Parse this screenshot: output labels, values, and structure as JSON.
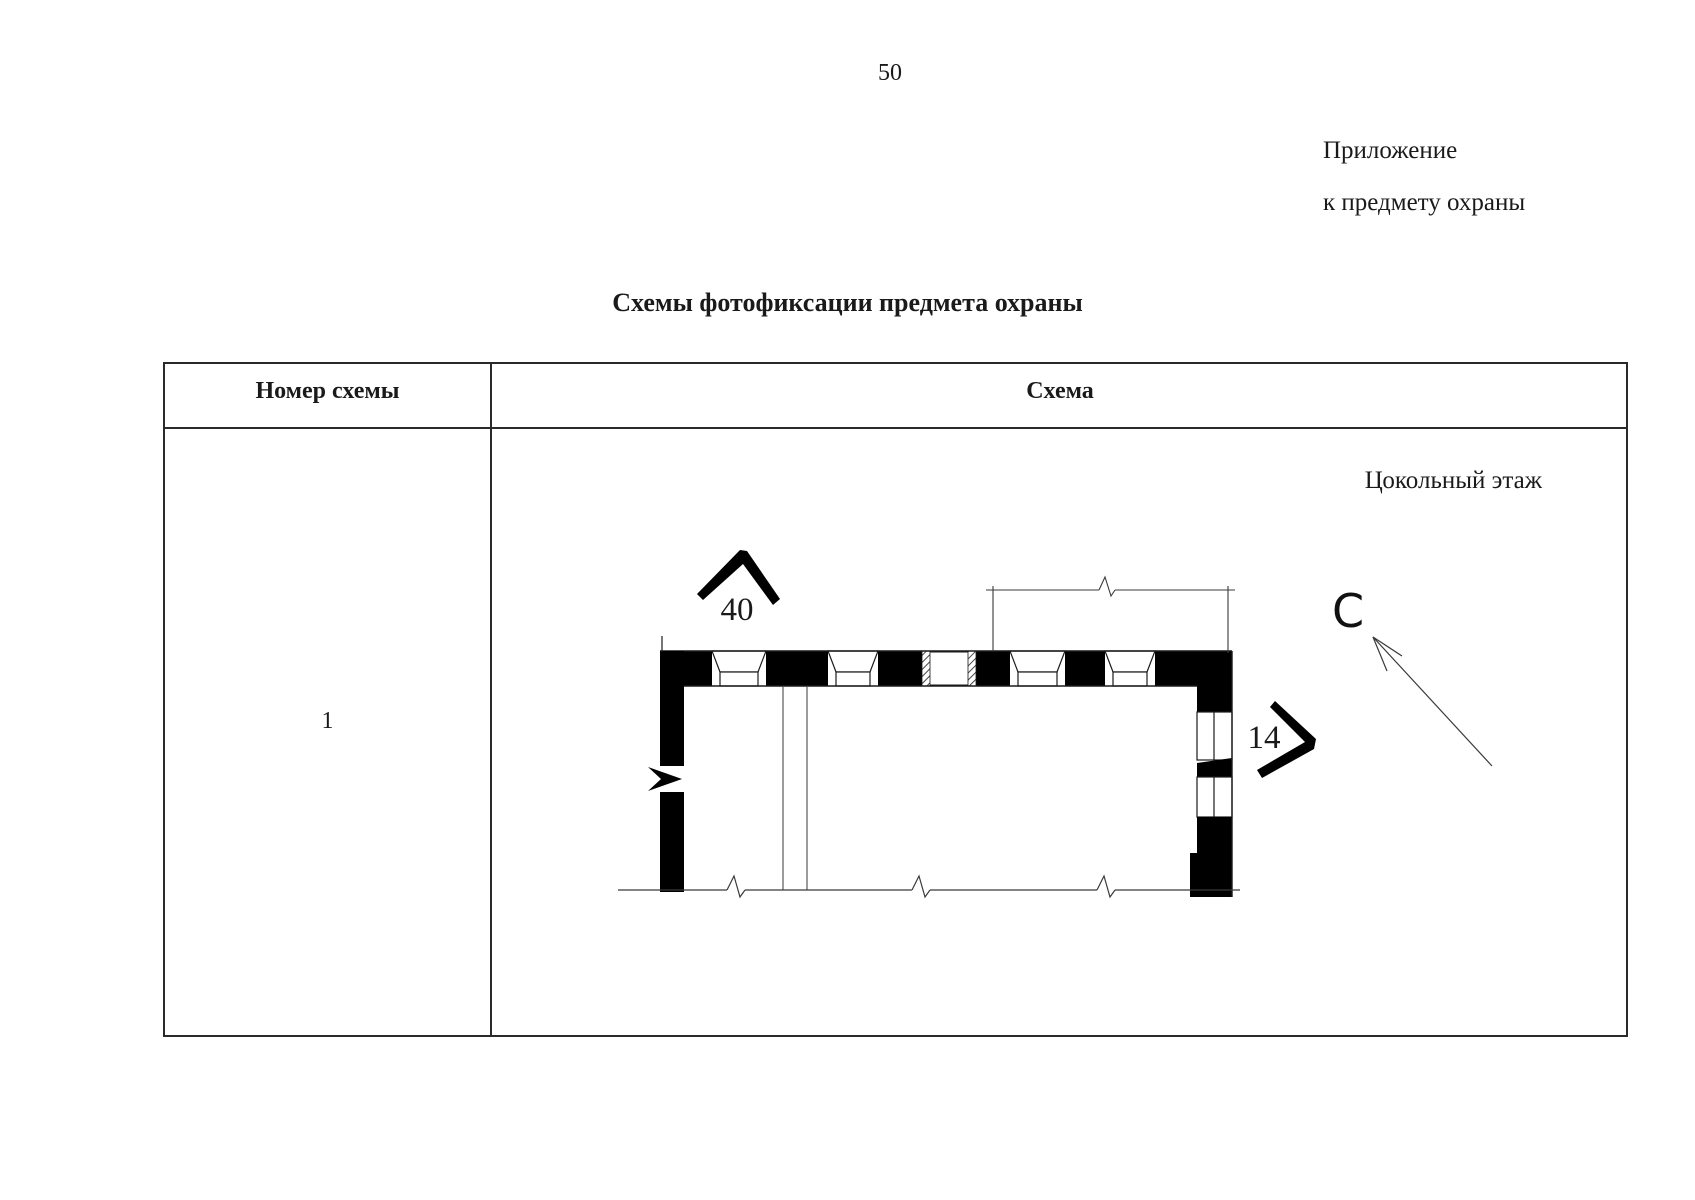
{
  "page": {
    "number": "50"
  },
  "annotation": {
    "line1": "Приложение",
    "line2": "к предмету охраны"
  },
  "title": "Схемы фотофиксации предмета охраны",
  "table": {
    "headers": {
      "col1": "Номер схемы",
      "col2": "Схема"
    },
    "rows": [
      {
        "number": "1",
        "floor_label": "Цокольный этаж"
      }
    ]
  },
  "plan": {
    "labels": {
      "camera_top": "40",
      "camera_right": "14",
      "north": "С"
    }
  },
  "colors": {
    "ink": "#1a1a1a",
    "paper": "#ffffff",
    "line": "#2a2a2a"
  }
}
